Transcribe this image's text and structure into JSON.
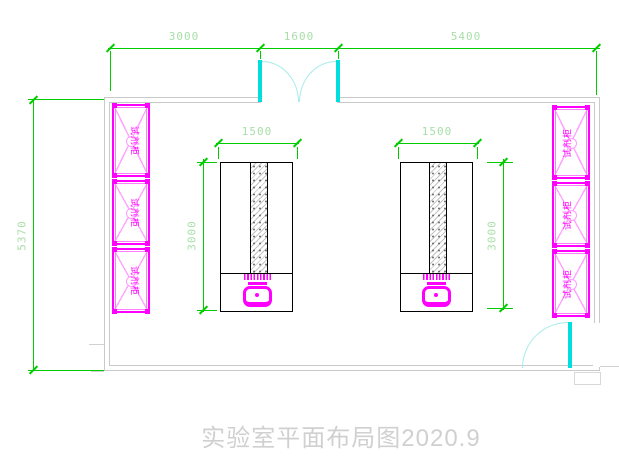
{
  "title": "实验室平面布局图2020.9",
  "dimensions": {
    "top": [
      "3000",
      "1600",
      "5400"
    ],
    "left_overall": "5370",
    "bench_width": "1500",
    "bench_depth": "3000"
  },
  "cabinets": {
    "label": "试剂柜",
    "left_count": 3,
    "right_count": 3
  },
  "colors": {
    "dimension_line": "#00cc00",
    "dimension_text": "#a8dea8",
    "cabinet": "#ff00ff",
    "cabinet_light": "#ffa3ff",
    "door_leaf": "#00dede",
    "door_arc": "#a8ecec",
    "wall": "#c9c9c9",
    "bench_outline": "#000000",
    "title_text": "#d0d0d0"
  }
}
